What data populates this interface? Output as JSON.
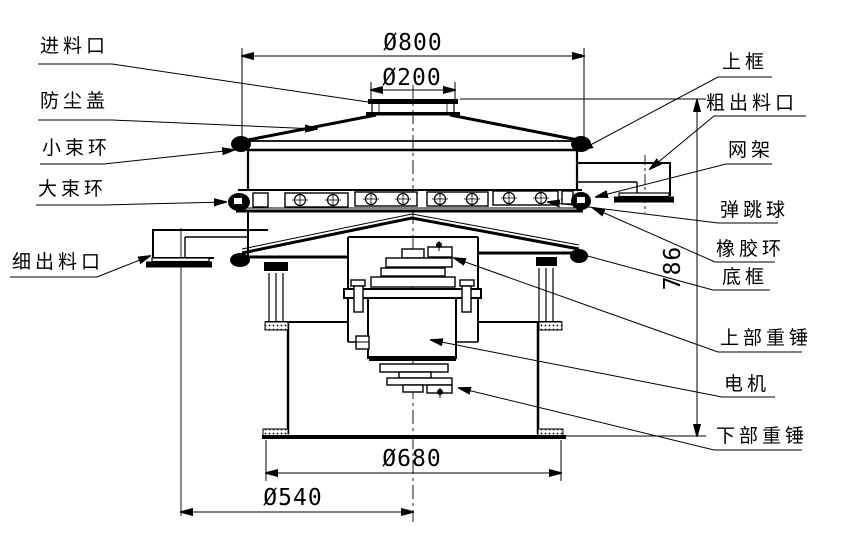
{
  "drawing": {
    "background": "#ffffff",
    "line_color": "#000000"
  },
  "labels": {
    "left": [
      {
        "id": "feed-inlet",
        "text": "进料口"
      },
      {
        "id": "dust-cover",
        "text": "防尘盖"
      },
      {
        "id": "small-clamp-ring",
        "text": "小束环"
      },
      {
        "id": "large-clamp-ring",
        "text": "大束环"
      },
      {
        "id": "fine-outlet",
        "text": "细出料口"
      }
    ],
    "right": [
      {
        "id": "upper-frame",
        "text": "上框"
      },
      {
        "id": "coarse-outlet",
        "text": "粗出料口"
      },
      {
        "id": "mesh-frame",
        "text": "网架"
      },
      {
        "id": "bouncing-ball",
        "text": "弹跳球"
      },
      {
        "id": "rubber-ring",
        "text": "橡胶环"
      },
      {
        "id": "bottom-frame",
        "text": "底框"
      },
      {
        "id": "upper-weight",
        "text": "上部重锤"
      },
      {
        "id": "motor",
        "text": "电机"
      },
      {
        "id": "lower-weight",
        "text": "下部重锤"
      }
    ]
  },
  "dimensions": {
    "top_diameter": "Ø800",
    "inlet_diameter": "Ø200",
    "overall_height": "786",
    "base_diameter": "Ø680",
    "outlet_circle_diameter": "Ø540"
  }
}
